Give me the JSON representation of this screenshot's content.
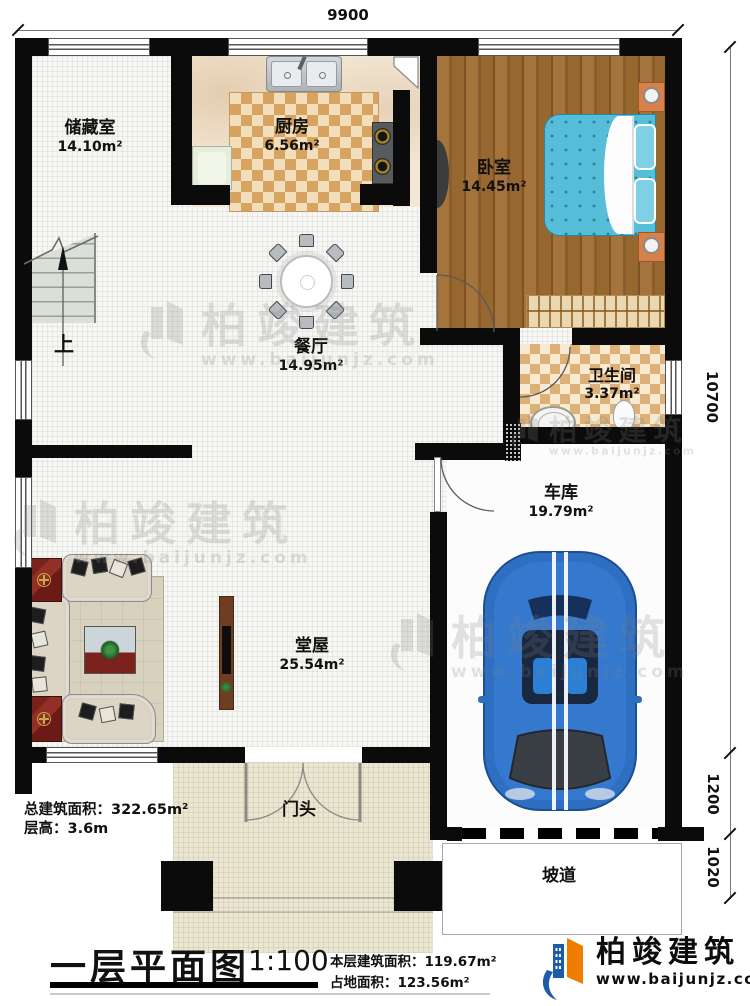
{
  "dims": {
    "top": "9900",
    "right_main": "10700",
    "right_seg1": "1200",
    "right_seg2": "1020"
  },
  "rooms": {
    "storage": {
      "name": "储藏室",
      "area": "14.10m²"
    },
    "kitchen": {
      "name": "厨房",
      "area": "6.56m²"
    },
    "bedroom": {
      "name": "卧室",
      "area": "14.45m²"
    },
    "dining": {
      "name": "餐厅",
      "area": "14.95m²"
    },
    "bath": {
      "name": "卫生间",
      "area": "3.37m²"
    },
    "garage": {
      "name": "车库",
      "area": "19.79m²"
    },
    "hall": {
      "name": "堂屋",
      "area": "25.54m²"
    },
    "porch": {
      "name": "门头"
    },
    "ramp": {
      "name": "坡道"
    }
  },
  "stairs": {
    "up_label": "上"
  },
  "summary": {
    "total_area": "总建筑面积：322.65m²",
    "floor_height": "层高：3.6m"
  },
  "titleblock": {
    "title": "一层平面图",
    "scale": "1:100",
    "floor_area": "本层建筑面积：119.67m²",
    "footprint": "占地面积：123.56m²"
  },
  "brand": {
    "name": "柏竣建筑",
    "site": "www.baijunjz.com"
  },
  "watermark": {
    "name": "柏竣建筑",
    "site": "www.baijunjz.com"
  },
  "colors": {
    "wall": "#0b0b0b",
    "brand_blue": "#1d5cab",
    "brand_orange": "#f07d00",
    "car_blue": "#2e6fc2",
    "bed_blue": "#57bed9"
  }
}
